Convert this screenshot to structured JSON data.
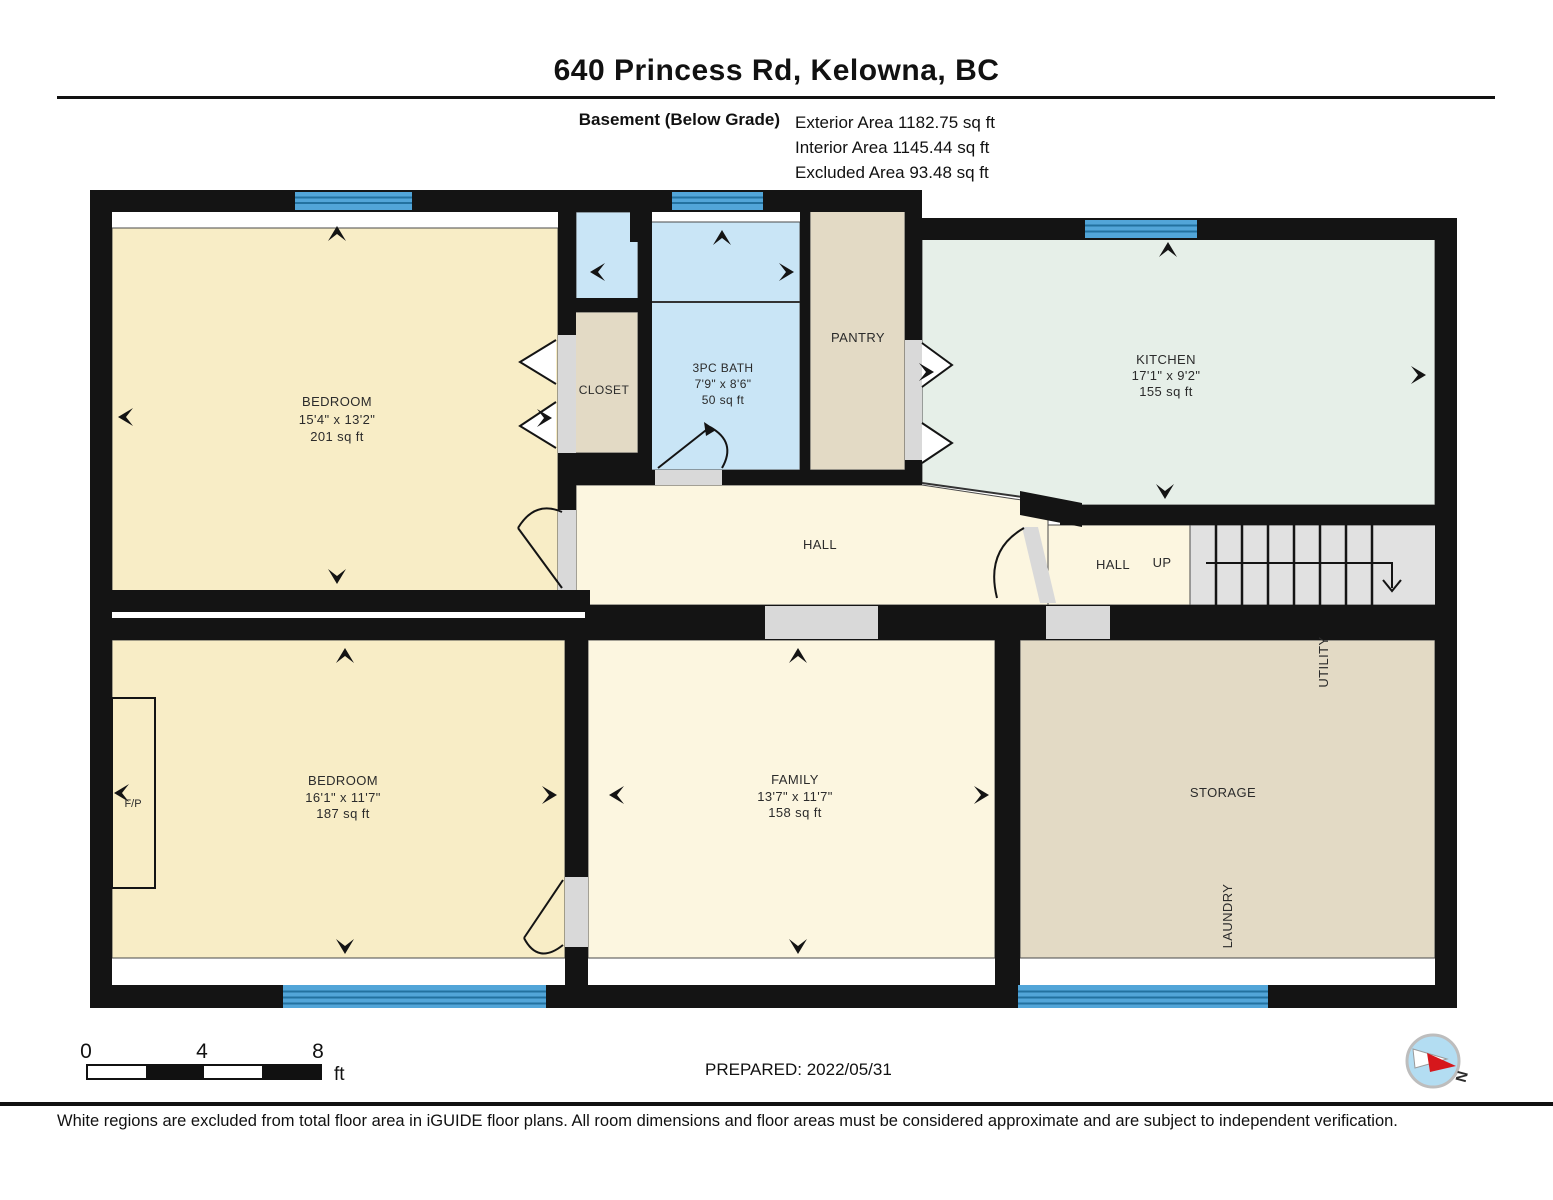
{
  "header": {
    "title": "640 Princess Rd, Kelowna, BC",
    "floor_label": "Basement (Below Grade)",
    "areas": {
      "exterior": "Exterior Area 1182.75 sq ft",
      "interior": "Interior Area 1145.44 sq ft",
      "excluded": "Excluded Area 93.48 sq ft"
    }
  },
  "rooms": {
    "bedroom_upper": {
      "name": "BEDROOM",
      "dims": "15'4\" x 13'2\"",
      "area": "201 sq ft"
    },
    "closet": {
      "name": "CLOSET"
    },
    "bath": {
      "name": "3PC BATH",
      "dims": "7'9\" x 8'6\"",
      "area": "50 sq ft"
    },
    "pantry": {
      "name": "PANTRY"
    },
    "kitchen": {
      "name": "KITCHEN",
      "dims": "17'1\" x 9'2\"",
      "area": "155 sq ft"
    },
    "hall": {
      "name": "HALL"
    },
    "hall_stairs": {
      "name": "HALL",
      "up_label": "UP"
    },
    "bedroom_lower": {
      "name": "BEDROOM",
      "dims": "16'1\" x 11'7\"",
      "area": "187 sq ft"
    },
    "family": {
      "name": "FAMILY",
      "dims": "13'7\" x 11'7\"",
      "area": "158 sq ft"
    },
    "storage": {
      "name": "STORAGE"
    },
    "utility": {
      "name": "UTILITY"
    },
    "laundry": {
      "name": "LAUNDRY"
    },
    "fireplace": {
      "name": "F/P"
    }
  },
  "scale_bar": {
    "tick_0": "0",
    "tick_4": "4",
    "tick_8": "8",
    "unit": "ft"
  },
  "footer": {
    "prepared": "PREPARED: 2022/05/31",
    "compass_north": "N",
    "disclaimer": "White regions are excluded from total floor area in iGUIDE floor plans. All room dimensions and floor areas must be considered approximate and are subject to independent verification."
  },
  "colors": {
    "wall": "#141414",
    "room_cream": "#f8edc6",
    "room_pale_cream": "#fcf6e0",
    "room_tan": "#e3dac5",
    "room_bath_blue": "#c9e5f6",
    "room_kitchen_green": "#e6efe8",
    "window_blue": "#52a5d8",
    "window_stripe": "#23719f",
    "stair_grey": "#e1e1e1",
    "door_grey": "#d9d9d9",
    "compass_blue": "#b3ddf2",
    "compass_red": "#d6171c"
  }
}
